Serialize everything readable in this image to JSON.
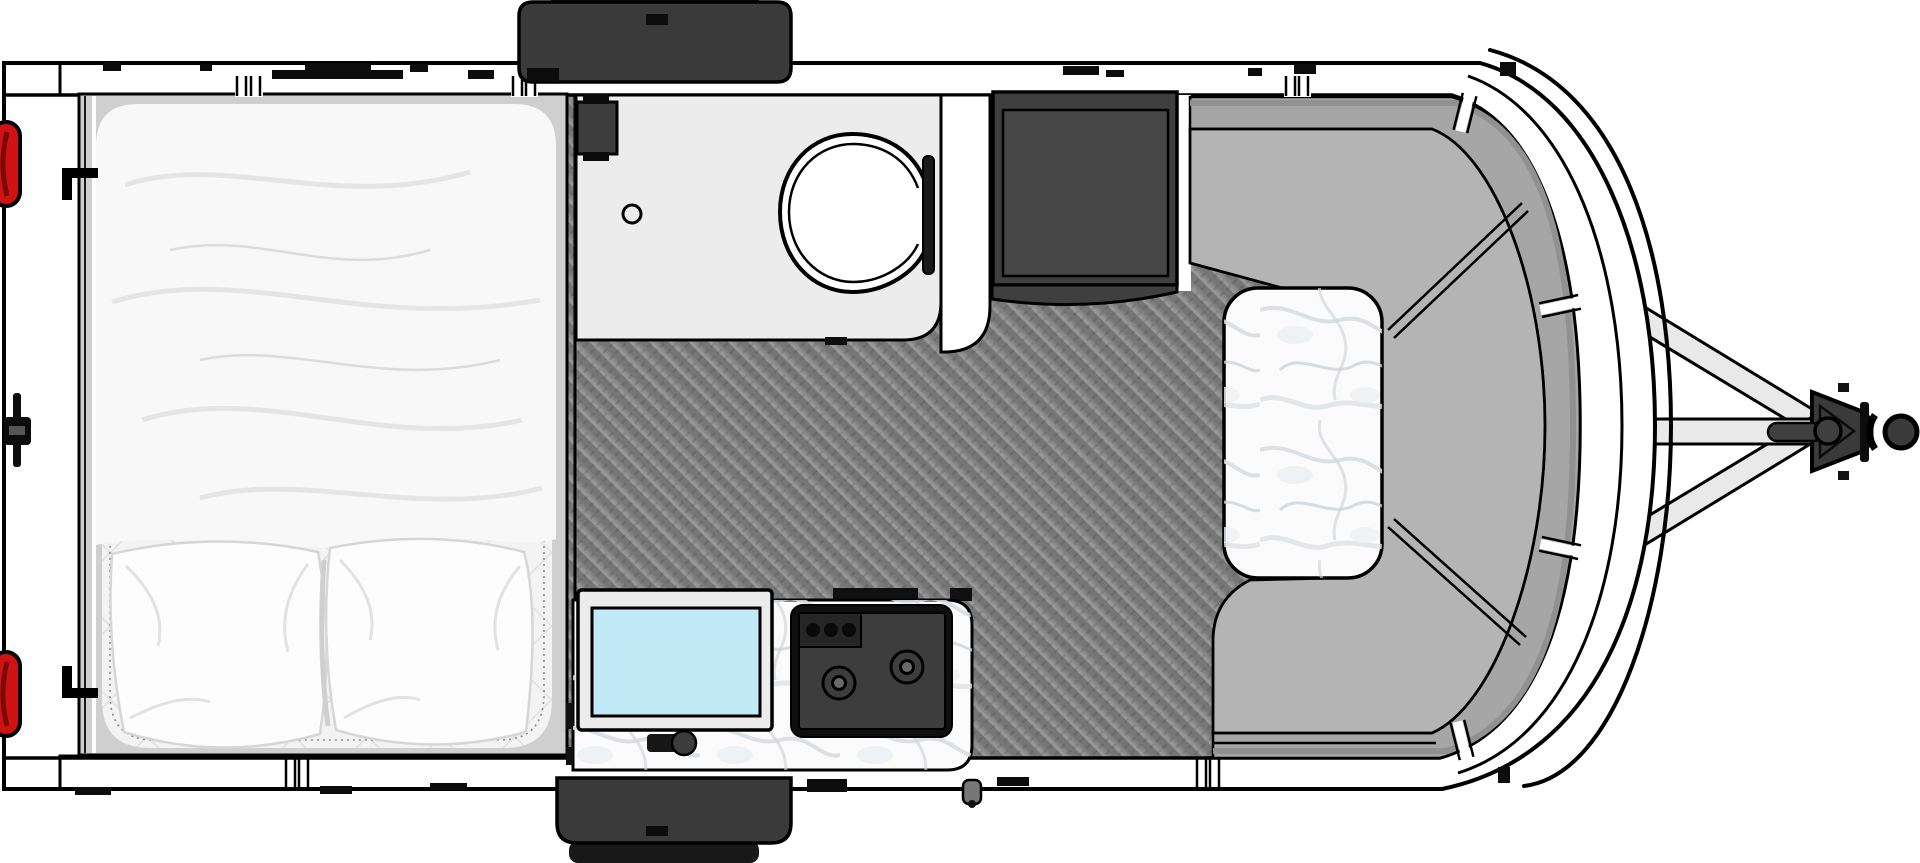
{
  "colors": {
    "background": "#ffffff",
    "outline": "#000000",
    "wall_white": "#ffffff",
    "floor_base": "#8b8b8b",
    "bed_platform": "#cfcfcf",
    "bedding": "#f8f8f8",
    "quilt": "#f3f3f3",
    "pillow": "#fdfdfd",
    "bathroom_floor": "#ececec",
    "fixture_dark": "#3d3d3d",
    "cabinet": "#3f3f3f",
    "cabinet_inner": "#474747",
    "cushion": "#b4b4b4",
    "seat_back": "#a6a6a6",
    "marble_base": "#fbfbfb",
    "sink_water": "#c2e9f6",
    "stove_frame": "#0f0f0f",
    "stove_panel": "#3d3d3d",
    "ac_unit": "#3a3a3a",
    "ac_cap": "#181818",
    "tail_light": "#cf1212",
    "tongue_beam": "#e9e9e9",
    "coupler": "#3a3a3a"
  },
  "elements": {
    "trailer_body": "trailer-body-outline",
    "bed": "bed-with-blanket-and-two-pillows",
    "bathroom": "wet-bath-with-toilet-and-shower",
    "wardrobe": "dark-wardrobe-cabinet",
    "dinette": "curved-front-dinette-with-marble-table",
    "kitchen": "counter-with-sink-and-two-burner-stove",
    "roof_unit_top": "roof-ac-unit-top",
    "roof_unit_bottom": "roof-ac-unit-bottom",
    "tail_lights": "two-red-marker-lights",
    "tongue": "a-frame-tongue-with-coupler"
  }
}
